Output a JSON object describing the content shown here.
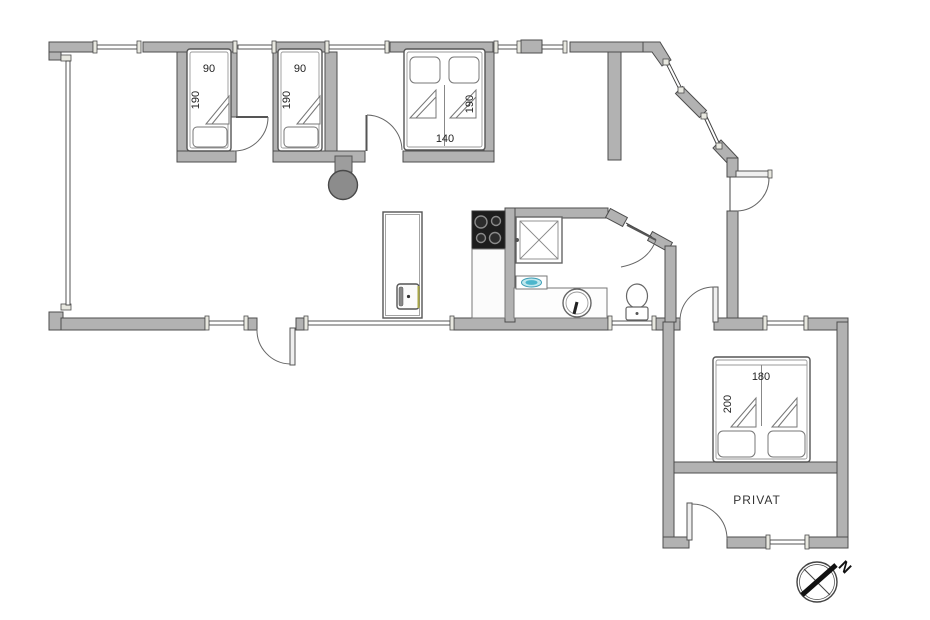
{
  "plan": {
    "rooms": {
      "privat": "PRIVAT"
    },
    "compass": {
      "north": "N"
    },
    "beds": {
      "bed1": {
        "width": "90",
        "length": "190"
      },
      "bed2": {
        "width": "90",
        "length": "190"
      },
      "bed3": {
        "width": "140",
        "length": "190"
      },
      "bed4": {
        "width": "180",
        "length": "200"
      }
    },
    "fixtures": [
      "shower",
      "washbasin",
      "hand-sink",
      "toilet",
      "cooktop",
      "oven-cabinet",
      "fireplace",
      "wood-stove",
      "compass-rose"
    ],
    "colors": {
      "wall": "#b2b2b2",
      "wall_outline": "#4d4d4d",
      "cooktop": "#1d1d1d",
      "sink_accent": "#4cb6cc",
      "fireplace": "#8c8c8c"
    }
  }
}
